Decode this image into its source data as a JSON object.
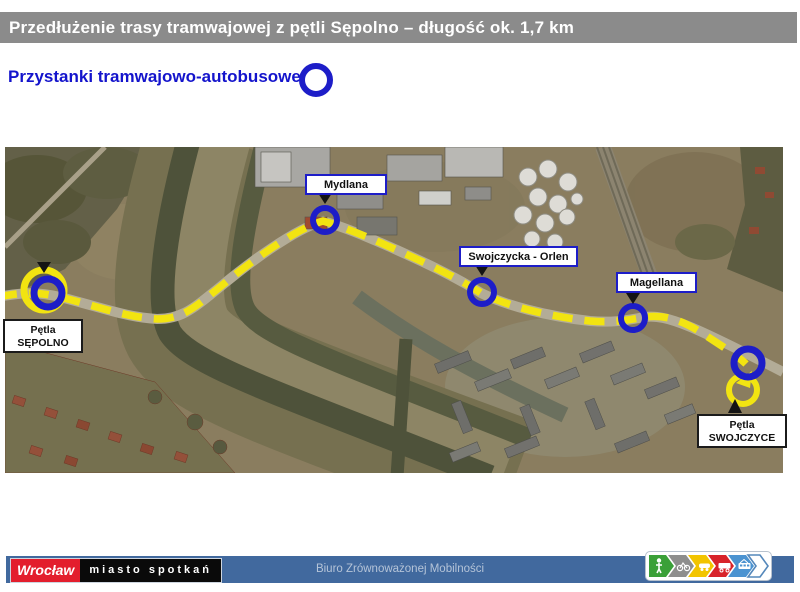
{
  "header": {
    "title": "Przedłużenie trasy tramwajowej z pętli Sępolno – długość ok. 1,7 km"
  },
  "legend": {
    "label": "Przystanki tramwajowo-autobusowe",
    "symbol": "blue-ring-stop-icon"
  },
  "map": {
    "type": "aerial-satellite-view",
    "route_color": "#f2e411",
    "stop_ring_color": "#1d1dc8",
    "stops": [
      {
        "name": "Mydlana"
      },
      {
        "name": "Swojczycka - Orlen"
      },
      {
        "name": "Magellana"
      }
    ],
    "loops": [
      {
        "line1": "Pętla",
        "line2": "SĘPOLNO"
      },
      {
        "line1": "Pętla",
        "line2": "SWOJCZYCE"
      }
    ]
  },
  "footer": {
    "logo_city": "Wrocław",
    "logo_tagline": "miasto spotkań",
    "office": "Biuro Zrównoważonej Mobilności",
    "mobility_icons": [
      "pedestrian-icon",
      "bicycle-icon",
      "car-icon",
      "bus-icon",
      "tram-icon",
      "empty-arrow-icon"
    ]
  }
}
